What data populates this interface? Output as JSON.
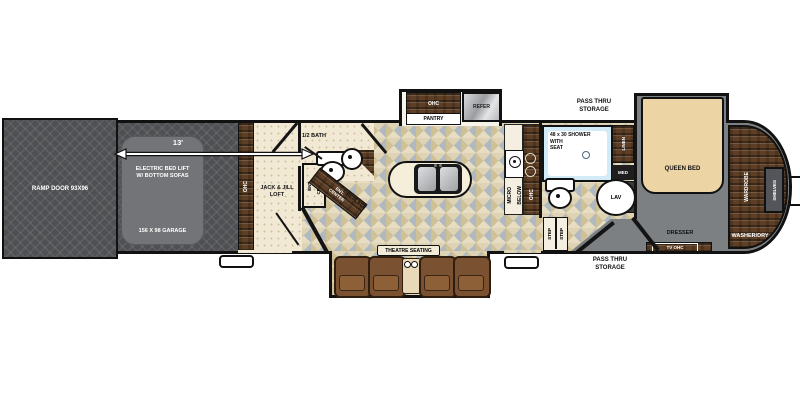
{
  "garage": {
    "ramp_door": "RAMP DOOR 93X96",
    "dimension": "13'",
    "bed_lift_line1": "ELECTRIC BED LIFT",
    "bed_lift_line2": "W/ BOTTOM SOFAS",
    "size": "156 X 98 GARAGE",
    "cabinet": "OHC"
  },
  "loft": {
    "line1": "JACK & JILL",
    "line2": "LOFT",
    "ent_line1": "ENT.",
    "ent_line2": "CENTER"
  },
  "half_bath": {
    "name": "1/2 BATH"
  },
  "living": {
    "fireplace_ent_line1": "ENT.",
    "fireplace_ent_line2": "CENTER",
    "fireplace": "FIREPLACE",
    "theatre": "THEATRE SEATING"
  },
  "kitchen": {
    "pantry_ohc": "OHC",
    "pantry": "PANTRY",
    "refer": "REFER",
    "micro": "MICRO",
    "below": "BELOW",
    "ohc": "OHC"
  },
  "bath": {
    "shower_line1": "48 x 30 SHOWER",
    "shower_line2": "WITH",
    "shower_line3": "SEAT",
    "linen": "LINEN",
    "med": "MED",
    "lav": "LAV",
    "step1": "STEP",
    "step2": "STEP"
  },
  "storage": {
    "top_line1": "PASS THRU",
    "top_line2": "STORAGE",
    "bottom_line1": "PASS THRU",
    "bottom_line2": "STORAGE"
  },
  "bedroom": {
    "bed": "QUEEN BED",
    "wardrobe": "WARDROBE",
    "shelves": "SHELVES",
    "dresser": "DRESSER",
    "tv": "TV OHC",
    "washer": "WASHER/DRY"
  },
  "colors": {
    "wall": "#141414",
    "garage_floor": "#4f5053",
    "bed_lift": "#737477",
    "loft_floor": "#f2e9d4",
    "tile_base": "#e6ddc2",
    "tile_accent": "#b0b8c0",
    "wood": "#5e3f26",
    "bedroom_floor": "#7d8083",
    "bed": "#ecd4a4",
    "shower": "#d3eaf7",
    "seat": "#7a5231"
  }
}
